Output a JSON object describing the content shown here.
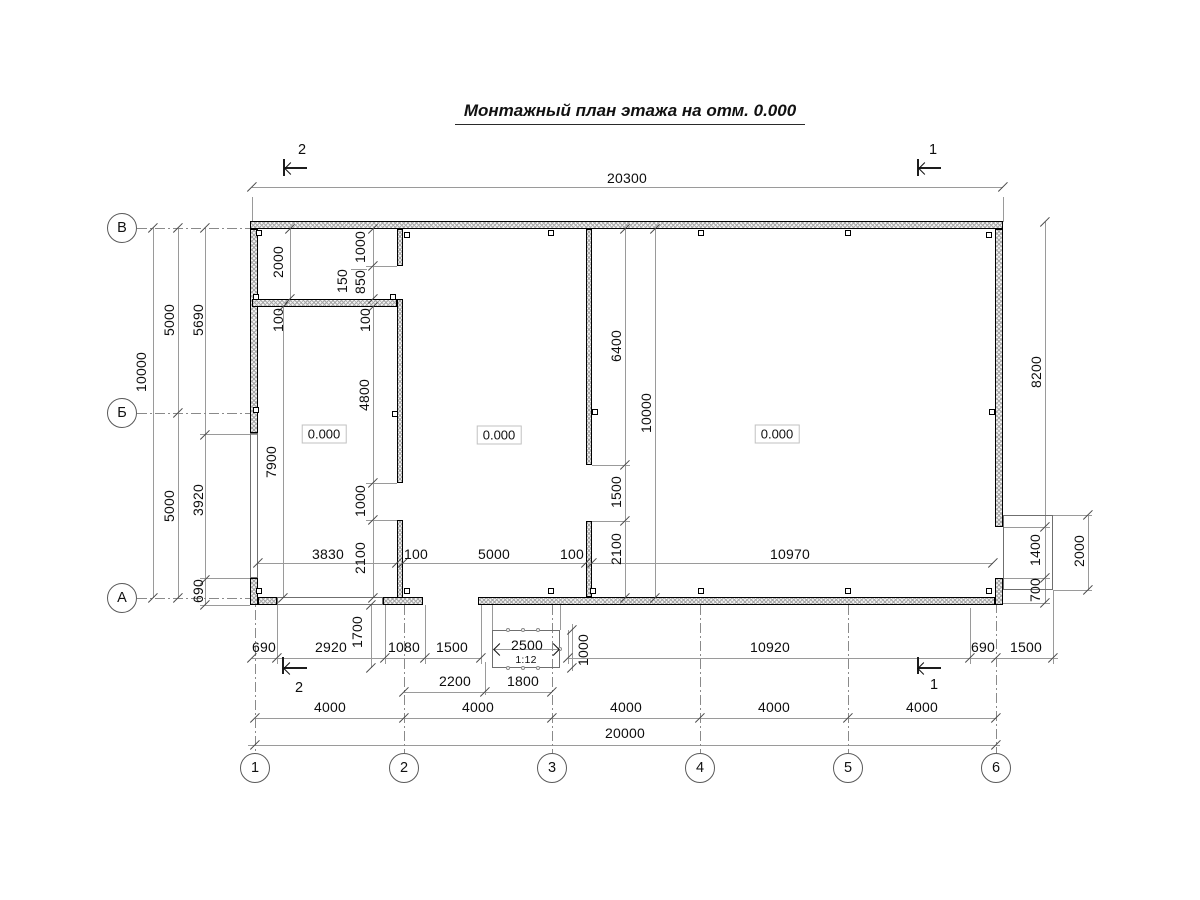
{
  "title": {
    "text": "Монтажный план этажа на отм. 0.000"
  },
  "room_levels": [
    {
      "text": "0.000",
      "x": 324,
      "y": 434
    },
    {
      "text": "0.000",
      "x": 499,
      "y": 435
    },
    {
      "text": "0.000",
      "x": 777,
      "y": 434
    }
  ],
  "axes": {
    "bottom": [
      {
        "label": "1",
        "x": 255
      },
      {
        "label": "2",
        "x": 404
      },
      {
        "label": "3",
        "x": 552
      },
      {
        "label": "4",
        "x": 700
      },
      {
        "label": "5",
        "x": 848
      },
      {
        "label": "6",
        "x": 996
      }
    ],
    "bottom_y": 768,
    "left": [
      {
        "label": "В",
        "y": 228
      },
      {
        "label": "Б",
        "y": 413
      },
      {
        "label": "А",
        "y": 598
      }
    ],
    "left_x": 122
  },
  "section_markers": [
    {
      "label": "2",
      "x": 302,
      "y": 150
    },
    {
      "label": "1",
      "x": 933,
      "y": 150
    },
    {
      "label": "2",
      "x": 299,
      "y": 688
    },
    {
      "label": "1",
      "x": 934,
      "y": 685
    }
  ],
  "dimensions": [
    {
      "text": "20300",
      "x": 627,
      "y": 178,
      "rot": 0
    },
    {
      "text": "10000",
      "x": 141,
      "y": 372,
      "rot": -90
    },
    {
      "text": "5000",
      "x": 169,
      "y": 320,
      "rot": -90
    },
    {
      "text": "5000",
      "x": 169,
      "y": 506,
      "rot": -90
    },
    {
      "text": "5690",
      "x": 198,
      "y": 320,
      "rot": -90
    },
    {
      "text": "3920",
      "x": 198,
      "y": 500,
      "rot": -90
    },
    {
      "text": "690",
      "x": 198,
      "y": 591,
      "rot": -90
    },
    {
      "text": "2000",
      "x": 278,
      "y": 262,
      "rot": -90
    },
    {
      "text": "1000",
      "x": 360,
      "y": 247,
      "rot": -90
    },
    {
      "text": "850",
      "x": 360,
      "y": 282,
      "rot": -90
    },
    {
      "text": "150",
      "x": 342,
      "y": 281,
      "rot": -90
    },
    {
      "text": "100",
      "x": 278,
      "y": 320,
      "rot": -90
    },
    {
      "text": "100",
      "x": 365,
      "y": 320,
      "rot": -90
    },
    {
      "text": "4800",
      "x": 364,
      "y": 395,
      "rot": -90
    },
    {
      "text": "7900",
      "x": 271,
      "y": 462,
      "rot": -90
    },
    {
      "text": "1000",
      "x": 360,
      "y": 501,
      "rot": -90
    },
    {
      "text": "2100",
      "x": 360,
      "y": 558,
      "rot": -90
    },
    {
      "text": "3830",
      "x": 328,
      "y": 554,
      "rot": 0
    },
    {
      "text": "100",
      "x": 416,
      "y": 554,
      "rot": 0
    },
    {
      "text": "5000",
      "x": 494,
      "y": 554,
      "rot": 0
    },
    {
      "text": "100",
      "x": 572,
      "y": 554,
      "rot": 0
    },
    {
      "text": "10970",
      "x": 790,
      "y": 554,
      "rot": 0
    },
    {
      "text": "6400",
      "x": 616,
      "y": 346,
      "rot": -90
    },
    {
      "text": "10000",
      "x": 646,
      "y": 413,
      "rot": -90
    },
    {
      "text": "1500",
      "x": 616,
      "y": 492,
      "rot": -90
    },
    {
      "text": "2100",
      "x": 616,
      "y": 549,
      "rot": -90
    },
    {
      "text": "8200",
      "x": 1036,
      "y": 372,
      "rot": -90
    },
    {
      "text": "1400",
      "x": 1035,
      "y": 550,
      "rot": -90
    },
    {
      "text": "700",
      "x": 1035,
      "y": 590,
      "rot": -90
    },
    {
      "text": "2000",
      "x": 1079,
      "y": 551,
      "rot": -90
    },
    {
      "text": "690",
      "x": 264,
      "y": 647,
      "rot": 0
    },
    {
      "text": "2920",
      "x": 331,
      "y": 647,
      "rot": 0
    },
    {
      "text": "1700",
      "x": 357,
      "y": 632,
      "rot": -90
    },
    {
      "text": "1080",
      "x": 404,
      "y": 647,
      "rot": 0
    },
    {
      "text": "1500",
      "x": 452,
      "y": 647,
      "rot": 0
    },
    {
      "text": "2500",
      "x": 527,
      "y": 645,
      "rot": 0
    },
    {
      "text": "1:12",
      "x": 526,
      "y": 660,
      "rot": 0,
      "small": true
    },
    {
      "text": "1000",
      "x": 583,
      "y": 650,
      "rot": -90
    },
    {
      "text": "10920",
      "x": 770,
      "y": 647,
      "rot": 0
    },
    {
      "text": "690",
      "x": 983,
      "y": 647,
      "rot": 0
    },
    {
      "text": "1500",
      "x": 1026,
      "y": 647,
      "rot": 0
    },
    {
      "text": "2200",
      "x": 455,
      "y": 681,
      "rot": 0
    },
    {
      "text": "1800",
      "x": 523,
      "y": 681,
      "rot": 0
    },
    {
      "text": "4000",
      "x": 330,
      "y": 707,
      "rot": 0
    },
    {
      "text": "4000",
      "x": 478,
      "y": 707,
      "rot": 0
    },
    {
      "text": "4000",
      "x": 626,
      "y": 707,
      "rot": 0
    },
    {
      "text": "4000",
      "x": 774,
      "y": 707,
      "rot": 0
    },
    {
      "text": "4000",
      "x": 922,
      "y": 707,
      "rot": 0
    },
    {
      "text": "20000",
      "x": 625,
      "y": 733,
      "rot": 0
    }
  ]
}
